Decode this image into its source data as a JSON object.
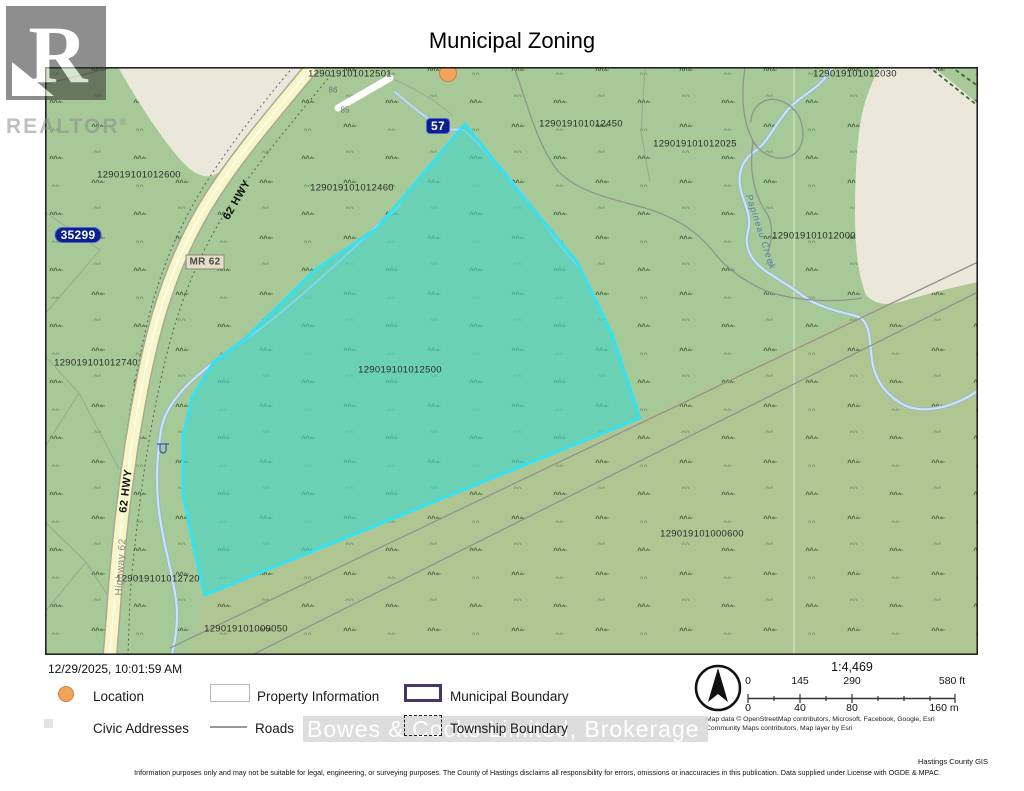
{
  "header": {
    "title": "Municipal Zoning"
  },
  "branding": {
    "logo_letter": "R",
    "wordmark": "REALTOR",
    "registered": "®"
  },
  "map": {
    "highlighted_parcel": "129019101012500",
    "labels": [
      {
        "name": "parcel-label-129019101012501",
        "text": "129019101012501",
        "x": 305,
        "y": 7,
        "cls": ""
      },
      {
        "name": "parcel-label-129019101012030",
        "text": "129019101012030",
        "x": 810,
        "y": 7,
        "cls": ""
      },
      {
        "name": "parcel-label-129019101012450",
        "text": "129019101012450",
        "x": 536,
        "y": 57,
        "cls": ""
      },
      {
        "name": "parcel-label-129019101012025",
        "text": "129019101012025",
        "x": 650,
        "y": 77,
        "cls": ""
      },
      {
        "name": "parcel-label-129019101012600",
        "text": "129019101012600",
        "x": 94,
        "y": 108,
        "cls": ""
      },
      {
        "name": "parcel-label-129019101012460",
        "text": "129019101012460",
        "x": 307,
        "y": 121,
        "cls": ""
      },
      {
        "name": "parcel-label-129019101012000",
        "text": "129019101012000",
        "x": 769,
        "y": 169,
        "cls": ""
      },
      {
        "name": "parcel-label-129019101012740",
        "text": "129019101012740",
        "x": 51,
        "y": 296,
        "cls": ""
      },
      {
        "name": "parcel-label-129019101012500",
        "text": "129019101012500",
        "x": 355,
        "y": 303,
        "cls": ""
      },
      {
        "name": "parcel-label-129019101012720",
        "text": "129019101012720",
        "x": 113,
        "y": 512,
        "cls": ""
      },
      {
        "name": "parcel-label-129019101009050",
        "text": "129019101009050",
        "x": 201,
        "y": 562,
        "cls": ""
      },
      {
        "name": "parcel-label-129019101000600",
        "text": "129019101000600",
        "x": 657,
        "y": 467,
        "cls": ""
      },
      {
        "name": "civic-address-86",
        "text": "86",
        "x": 288,
        "y": 23,
        "cls": "civic"
      },
      {
        "name": "civic-address-85",
        "text": "85",
        "x": 300,
        "y": 43,
        "cls": "civic"
      },
      {
        "name": "road-label-62hwy-upper",
        "text": "62 HWY",
        "x": 192,
        "y": 133,
        "rot": -60,
        "cls": "hwy"
      },
      {
        "name": "road-label-62hwy-lower",
        "text": "62 HWY",
        "x": 81,
        "y": 424,
        "rot": -83,
        "cls": "hwy"
      },
      {
        "name": "road-label-highway62",
        "text": "Highway 62",
        "x": 76,
        "y": 500,
        "rot": -86,
        "cls": "hwyname"
      },
      {
        "name": "road-label-mr62",
        "text": "MR 62",
        "x": 160,
        "y": 195,
        "cls": "mrbox"
      },
      {
        "name": "address-marker-35299",
        "text": "35299",
        "x": 33,
        "y": 168,
        "cls": "addrbox"
      },
      {
        "name": "highway-shield-57",
        "text": "57",
        "x": 393,
        "y": 59,
        "cls": "shield"
      },
      {
        "name": "creek-label",
        "text": "Papineau Creek",
        "x": 716,
        "y": 165,
        "rot": 72,
        "cls": "creek"
      }
    ]
  },
  "footer": {
    "timestamp": "12/29/2025, 10:01:59 AM",
    "legend": {
      "location": "Location",
      "property_information": "Property Information",
      "municipal_boundary": "Municipal Boundary",
      "civic_addresses": "Civic Addresses",
      "roads": "Roads",
      "township_boundary": "Township Boundary"
    },
    "watermark": "Bowes & Cocks Limited, Brokerage",
    "scale": {
      "ratio": "1:4,469",
      "ft_ticks": [
        "0",
        "145",
        "290",
        "580 ft"
      ],
      "m_ticks": [
        "0",
        "40",
        "80",
        "160 m"
      ]
    },
    "attribution_line1": "Map data © OpenStreetMap contributors, Microsoft, Facebook, Google, Esri",
    "attribution_line2": "Community Maps contributors, Map layer by Esri",
    "gis_credit": "Hastings County GIS",
    "disclaimer": "Information purposes only and may not be suitable for legal, engineering, or surveying purposes.  The County of Hastings disclaims all responsibility for errors, omissions or inaccuracies in this publication. Data supplied under License with OGDE & MPAC."
  },
  "colors": {
    "map_green": "#a6c997",
    "map_olive": "#b0c692",
    "no_data_beige": "#ebe8db",
    "highlight_fill": "#78d7bc",
    "highlight_border": "#35e2f2",
    "highway_yellow": "#f8f5c6",
    "municipal_purple": "#463569",
    "location_orange": "#f2a45f"
  }
}
